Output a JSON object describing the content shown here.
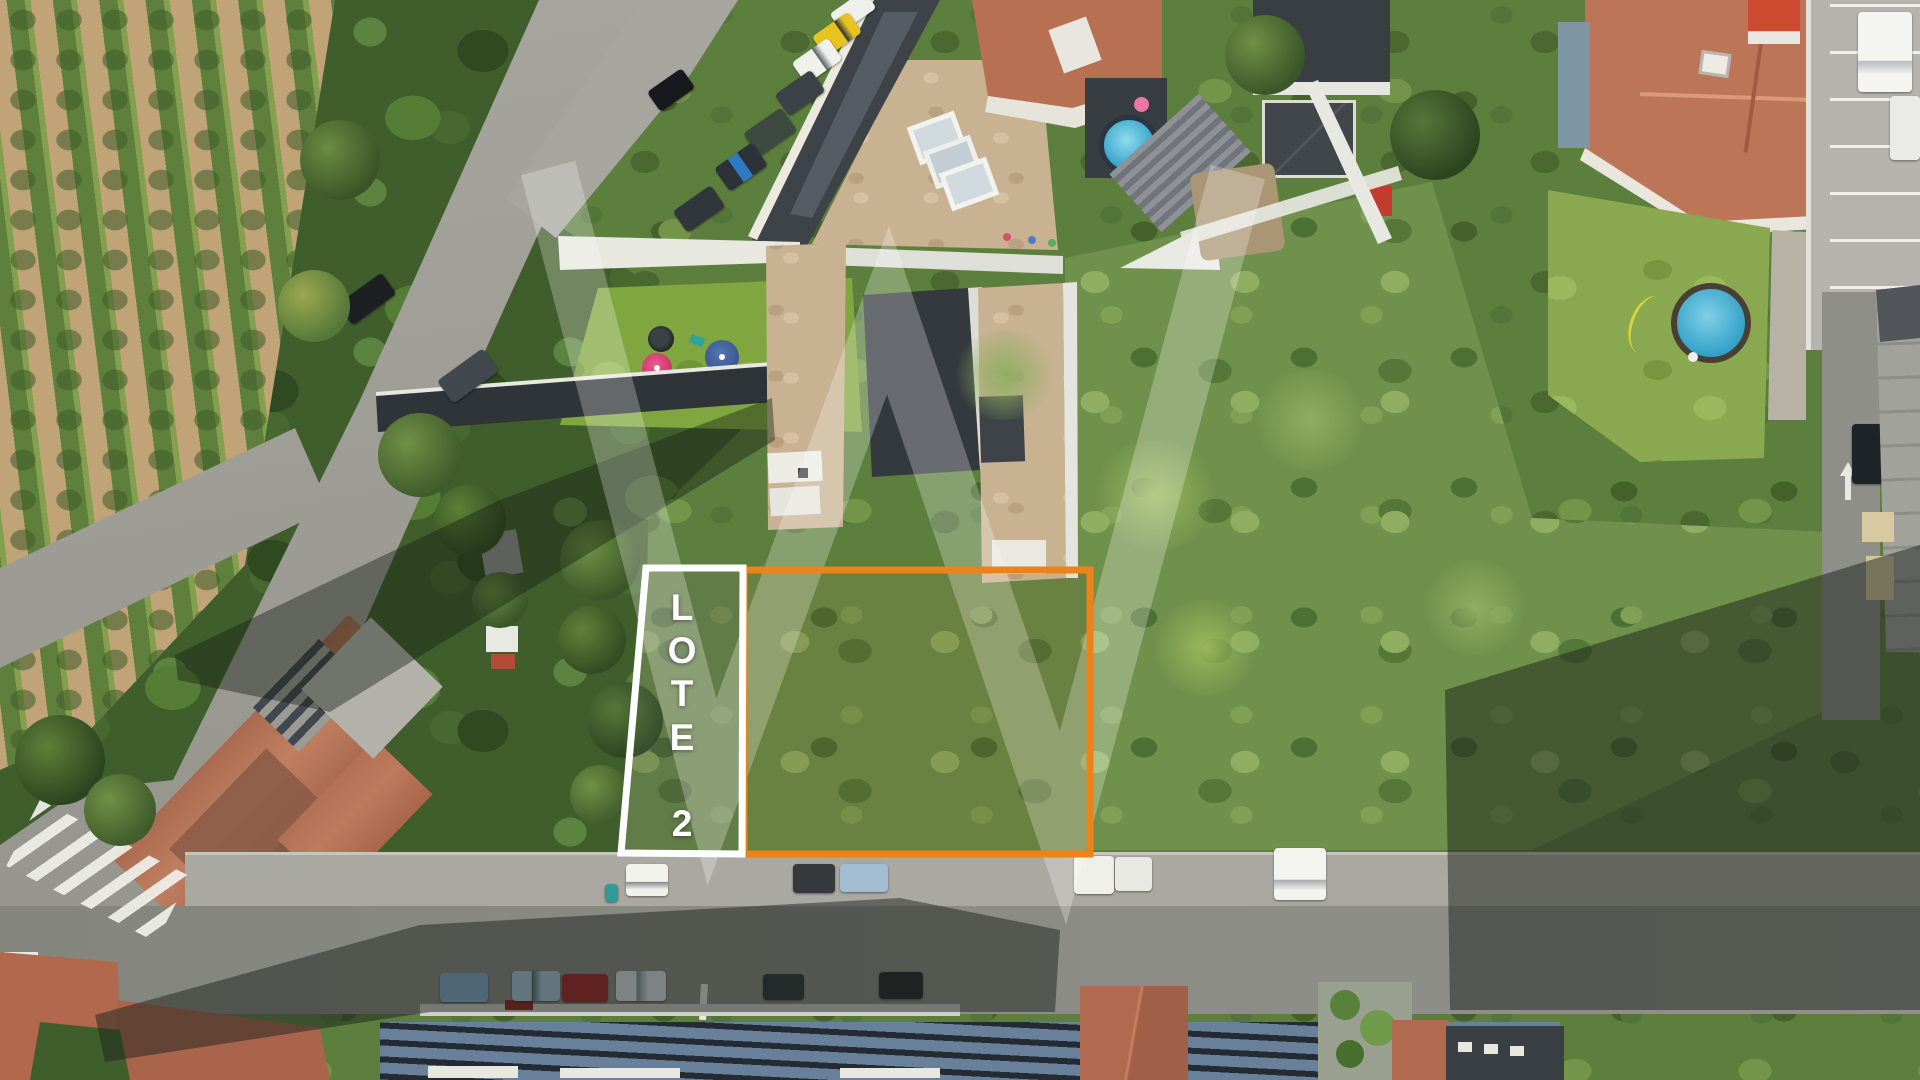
{
  "page": {
    "title": "Aerial drone photo of building lots"
  },
  "annotations": {
    "lot_label": {
      "text": "LOTE 2",
      "letters": [
        "L",
        "O",
        "T",
        "E",
        "2"
      ]
    },
    "lot_outline_color": "#EC8218",
    "strip_outline_color": "#FFFFFF",
    "watermark_color": "rgba(255,255,255,0.26)"
  }
}
